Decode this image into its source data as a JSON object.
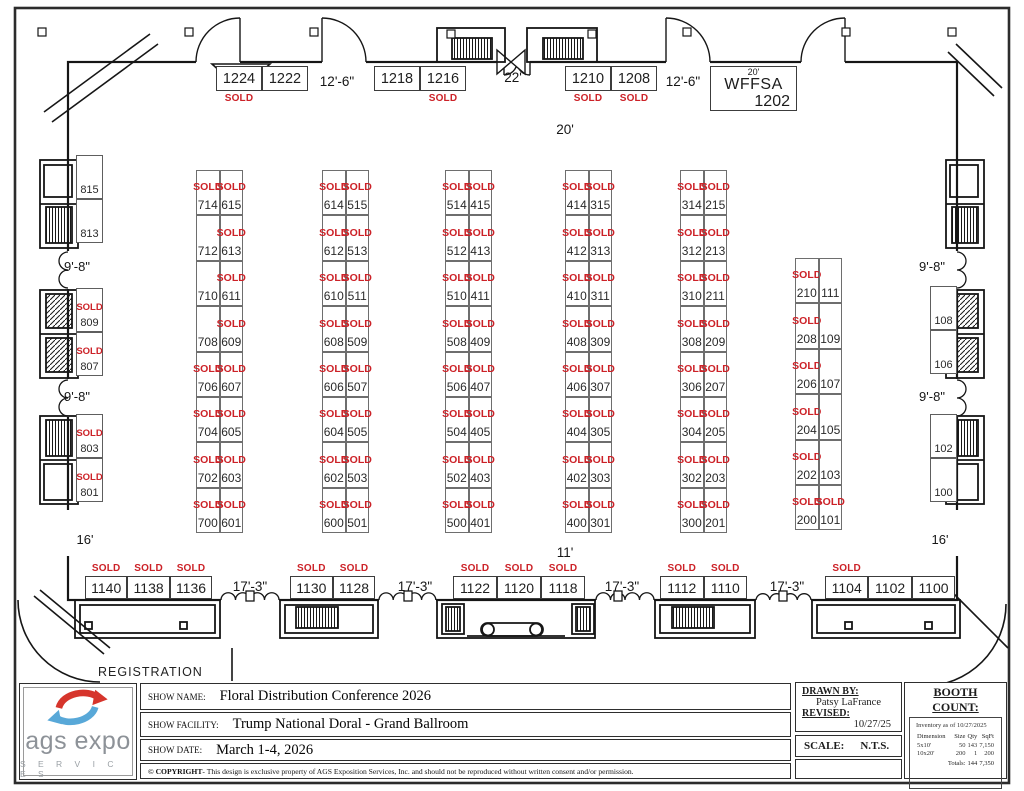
{
  "colors": {
    "sold": "#cc2127",
    "wall": "#161616",
    "accent_red": "#d6352c",
    "accent_blue": "#58a8d8"
  },
  "labels": {
    "sold": "SOLD",
    "registration": "REGISTRATION",
    "dim_top_center": "20'",
    "dim_bottom_center": "11'"
  },
  "plan": {
    "top_row": {
      "groups": [
        [
          [
            "1224",
            1
          ],
          [
            "1222",
            0
          ]
        ],
        [
          [
            "1218",
            0
          ],
          [
            "1216",
            1
          ]
        ],
        [
          [
            "1210",
            1
          ],
          [
            "1208",
            1
          ]
        ]
      ],
      "dims": [
        "12'-6\"",
        "22'",
        "12'-6\""
      ]
    },
    "special_booth": {
      "size": "20'",
      "name": "WFFSA",
      "num": "1202"
    },
    "islands": [
      {
        "rows": [
          [
            "714",
            1,
            "615",
            1
          ],
          [
            "712",
            0,
            "613",
            1
          ],
          [
            "710",
            0,
            "611",
            1
          ],
          [
            "708",
            0,
            "609",
            1
          ],
          [
            "706",
            1,
            "607",
            1
          ],
          [
            "704",
            1,
            "605",
            1
          ],
          [
            "702",
            1,
            "603",
            1
          ],
          [
            "700",
            1,
            "601",
            1
          ]
        ]
      },
      {
        "rows": [
          [
            "614",
            1,
            "515",
            1
          ],
          [
            "612",
            1,
            "513",
            1
          ],
          [
            "610",
            1,
            "511",
            1
          ],
          [
            "608",
            1,
            "509",
            1
          ],
          [
            "606",
            1,
            "507",
            1
          ],
          [
            "604",
            1,
            "505",
            1
          ],
          [
            "602",
            1,
            "503",
            1
          ],
          [
            "600",
            1,
            "501",
            1
          ]
        ]
      },
      {
        "rows": [
          [
            "514",
            1,
            "415",
            1
          ],
          [
            "512",
            1,
            "413",
            1
          ],
          [
            "510",
            1,
            "411",
            1
          ],
          [
            "508",
            1,
            "409",
            1
          ],
          [
            "506",
            1,
            "407",
            1
          ],
          [
            "504",
            1,
            "405",
            1
          ],
          [
            "502",
            1,
            "403",
            1
          ],
          [
            "500",
            1,
            "401",
            1
          ]
        ]
      },
      {
        "rows": [
          [
            "414",
            1,
            "315",
            1
          ],
          [
            "412",
            1,
            "313",
            1
          ],
          [
            "410",
            1,
            "311",
            1
          ],
          [
            "408",
            1,
            "309",
            1
          ],
          [
            "406",
            1,
            "307",
            1
          ],
          [
            "404",
            1,
            "305",
            1
          ],
          [
            "402",
            1,
            "303",
            1
          ],
          [
            "400",
            1,
            "301",
            1
          ]
        ]
      },
      {
        "rows": [
          [
            "314",
            1,
            "215",
            1
          ],
          [
            "312",
            1,
            "213",
            1
          ],
          [
            "310",
            1,
            "211",
            1
          ],
          [
            "308",
            1,
            "209",
            1
          ],
          [
            "306",
            1,
            "207",
            1
          ],
          [
            "304",
            1,
            "205",
            1
          ],
          [
            "302",
            1,
            "203",
            1
          ],
          [
            "300",
            1,
            "201",
            1
          ]
        ]
      },
      {
        "rows": [
          [
            "210",
            1,
            "111",
            0
          ],
          [
            "208",
            1,
            "109",
            0
          ],
          [
            "206",
            1,
            "107",
            0
          ],
          [
            "204",
            1,
            "105",
            0
          ],
          [
            "202",
            1,
            "103",
            0
          ],
          [
            "200",
            1,
            "101",
            1
          ]
        ]
      }
    ],
    "left_wall": {
      "cells": [
        [
          "815",
          0
        ],
        [
          "813",
          0
        ],
        [
          "809",
          1
        ],
        [
          "807",
          1
        ],
        [
          "803",
          1
        ],
        [
          "801",
          1
        ]
      ],
      "dims": [
        "9'-8\"",
        "9'-8\"",
        "16'"
      ]
    },
    "right_wall": {
      "cells": [
        [
          "108",
          0
        ],
        [
          "106",
          0
        ],
        [
          "102",
          0
        ],
        [
          "100",
          0
        ]
      ],
      "dims": [
        "9'-8\"",
        "9'-8\"",
        "16'"
      ]
    },
    "bottom_row": {
      "groups": [
        [
          [
            "1140",
            1
          ],
          [
            "1138",
            1
          ],
          [
            "1136",
            1
          ]
        ],
        [
          [
            "1130",
            1
          ],
          [
            "1128",
            1
          ]
        ],
        [
          [
            "1122",
            1
          ],
          [
            "1120",
            1
          ],
          [
            "1118",
            1
          ]
        ],
        [
          [
            "1112",
            1
          ],
          [
            "1110",
            1
          ]
        ],
        [
          [
            "1104",
            1
          ],
          [
            "1102",
            0
          ],
          [
            "1100",
            0
          ]
        ]
      ],
      "dims": [
        "17'-3\"",
        "17'-3\"",
        "17'-3\"",
        "17'-3\""
      ]
    }
  },
  "title_block": {
    "logo": {
      "line1": "ags expo",
      "line2": "S E R V I C E S"
    },
    "rows": [
      {
        "label": "SHOW NAME:",
        "value": "Floral Distribution Conference 2026"
      },
      {
        "label": "SHOW FACILITY:",
        "value": "Trump National Doral - Grand Ballroom"
      },
      {
        "label": "SHOW DATE:",
        "value": "March 1-4, 2026"
      }
    ],
    "copyright_prefix": "© COPYRIGHT",
    "copyright_rest": " - This design is exclusive property of AGS Exposition Services, Inc. and should not be reproduced without written consent and/or permission.",
    "drawn_by_label": "DRAWN BY:",
    "drawn_by": "Patsy LaFrance",
    "revised_label": "REVISED:",
    "revised": "10/27/25",
    "scale_label": "SCALE:",
    "scale": "N.T.S.",
    "booth_count": {
      "title": "BOOTH COUNT:",
      "note": "Inventory as of 10/27/2025",
      "headers": [
        "Dimension",
        "Size",
        "Qty",
        "SqFt"
      ],
      "rows": [
        [
          "5x10'",
          "50",
          "143",
          "7,150"
        ],
        [
          "10x20'",
          "200",
          "1",
          "200"
        ]
      ],
      "totals": [
        "",
        "Totals:",
        "144",
        "7,350"
      ]
    }
  }
}
